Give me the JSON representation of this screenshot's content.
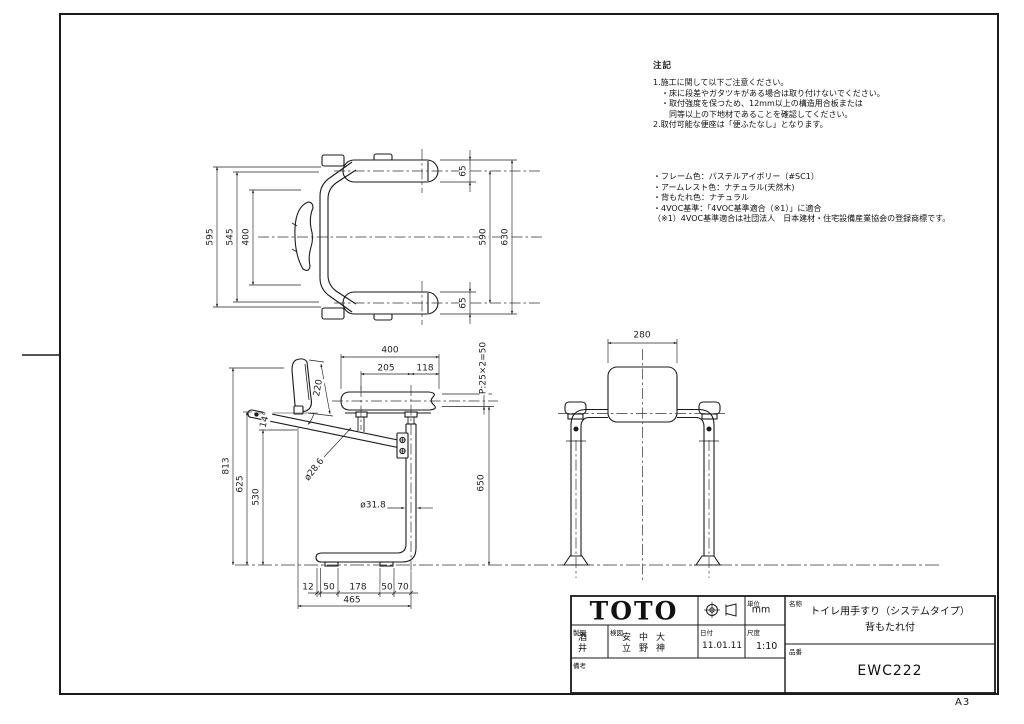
{
  "sheet": {
    "size_label": "A3"
  },
  "notes": {
    "title": "注記",
    "lines": [
      "1.施工に関して以下ご注意ください。",
      "　・床に段差やガタツキがある場合は取り付けないでください。",
      "　・取付強度を保つため、12mm以上の構造用合板または",
      "　　同等以上の下地材であることを確認してください。",
      "2.取付可能な便座は「便ふたなし」となります。"
    ]
  },
  "specs": {
    "lines": [
      "・フレーム色：パステルアイボリー（#SC1）",
      "・アームレスト色：ナチュラル(天然木)",
      "・背もたれ色：ナチュラル",
      "・4VOC基準：「4VOC基準適合（※1）」に適合",
      "（※1）4VOC基準適合は社団法人　日本建材・住宅設備産業協会の登録商標です。"
    ]
  },
  "views": {
    "plan": {
      "dims": [
        {
          "t": "595",
          "x": 211,
          "y": 237,
          "r": -90
        },
        {
          "t": "545",
          "x": 231,
          "y": 237,
          "r": -90
        },
        {
          "t": "400",
          "x": 247,
          "y": 237,
          "r": -90
        },
        {
          "t": "65",
          "x": 464,
          "y": 171,
          "r": -90
        },
        {
          "t": "590",
          "x": 484,
          "y": 237,
          "r": -90
        },
        {
          "t": "630",
          "x": 506,
          "y": 237,
          "r": -90
        },
        {
          "t": "65",
          "x": 464,
          "y": 303,
          "r": -90
        }
      ]
    },
    "side": {
      "dims": [
        {
          "t": "400",
          "x": 390,
          "y": 351,
          "r": 0
        },
        {
          "t": "205",
          "x": 386,
          "y": 369,
          "r": 0
        },
        {
          "t": "118",
          "x": 425,
          "y": 369,
          "r": 0
        },
        {
          "t": "P:25×2=50",
          "x": 484,
          "y": 368,
          "r": -90
        },
        {
          "t": "650",
          "x": 482,
          "y": 483,
          "r": -90
        },
        {
          "t": "813",
          "x": 227,
          "y": 466,
          "r": -90
        },
        {
          "t": "625",
          "x": 241,
          "y": 484,
          "r": -90
        },
        {
          "t": "530",
          "x": 257,
          "y": 497,
          "r": -90
        },
        {
          "t": "14°",
          "x": 266,
          "y": 420,
          "r": -75
        },
        {
          "t": "220",
          "x": 319,
          "y": 388,
          "r": -80
        },
        {
          "t": "ø28.6",
          "x": 315,
          "y": 470,
          "r": -52
        },
        {
          "t": "ø31.8",
          "x": 373,
          "y": 506,
          "r": 0
        },
        {
          "t": "12",
          "x": 308,
          "y": 588,
          "r": 0
        },
        {
          "t": "50",
          "x": 329,
          "y": 588,
          "r": 0
        },
        {
          "t": "178",
          "x": 358,
          "y": 588,
          "r": 0
        },
        {
          "t": "50",
          "x": 387,
          "y": 588,
          "r": 0
        },
        {
          "t": "70",
          "x": 403,
          "y": 588,
          "r": 0
        },
        {
          "t": "465",
          "x": 352,
          "y": 601,
          "r": 0
        }
      ]
    },
    "front": {
      "dims": [
        {
          "t": "280",
          "x": 642,
          "y": 336,
          "r": 0
        }
      ]
    }
  },
  "title_block": {
    "logo": "TOTO",
    "unit_label": "単位",
    "unit_value": "mm",
    "drawn_label": "製図",
    "drawn_by": "酒井",
    "checked_label": "検図",
    "checked_by": [
      "安立",
      "中野",
      "大神"
    ],
    "date_label": "日付",
    "date_value": "11.01.11",
    "scale_label": "尺度",
    "scale_value": "1:10",
    "remarks_label": "備考",
    "name_label": "名称",
    "name_line1": "トイレ用手すり（システムタイプ）",
    "name_line2": "背もたれ付",
    "part_label": "品番",
    "part_number": "EWC222"
  }
}
